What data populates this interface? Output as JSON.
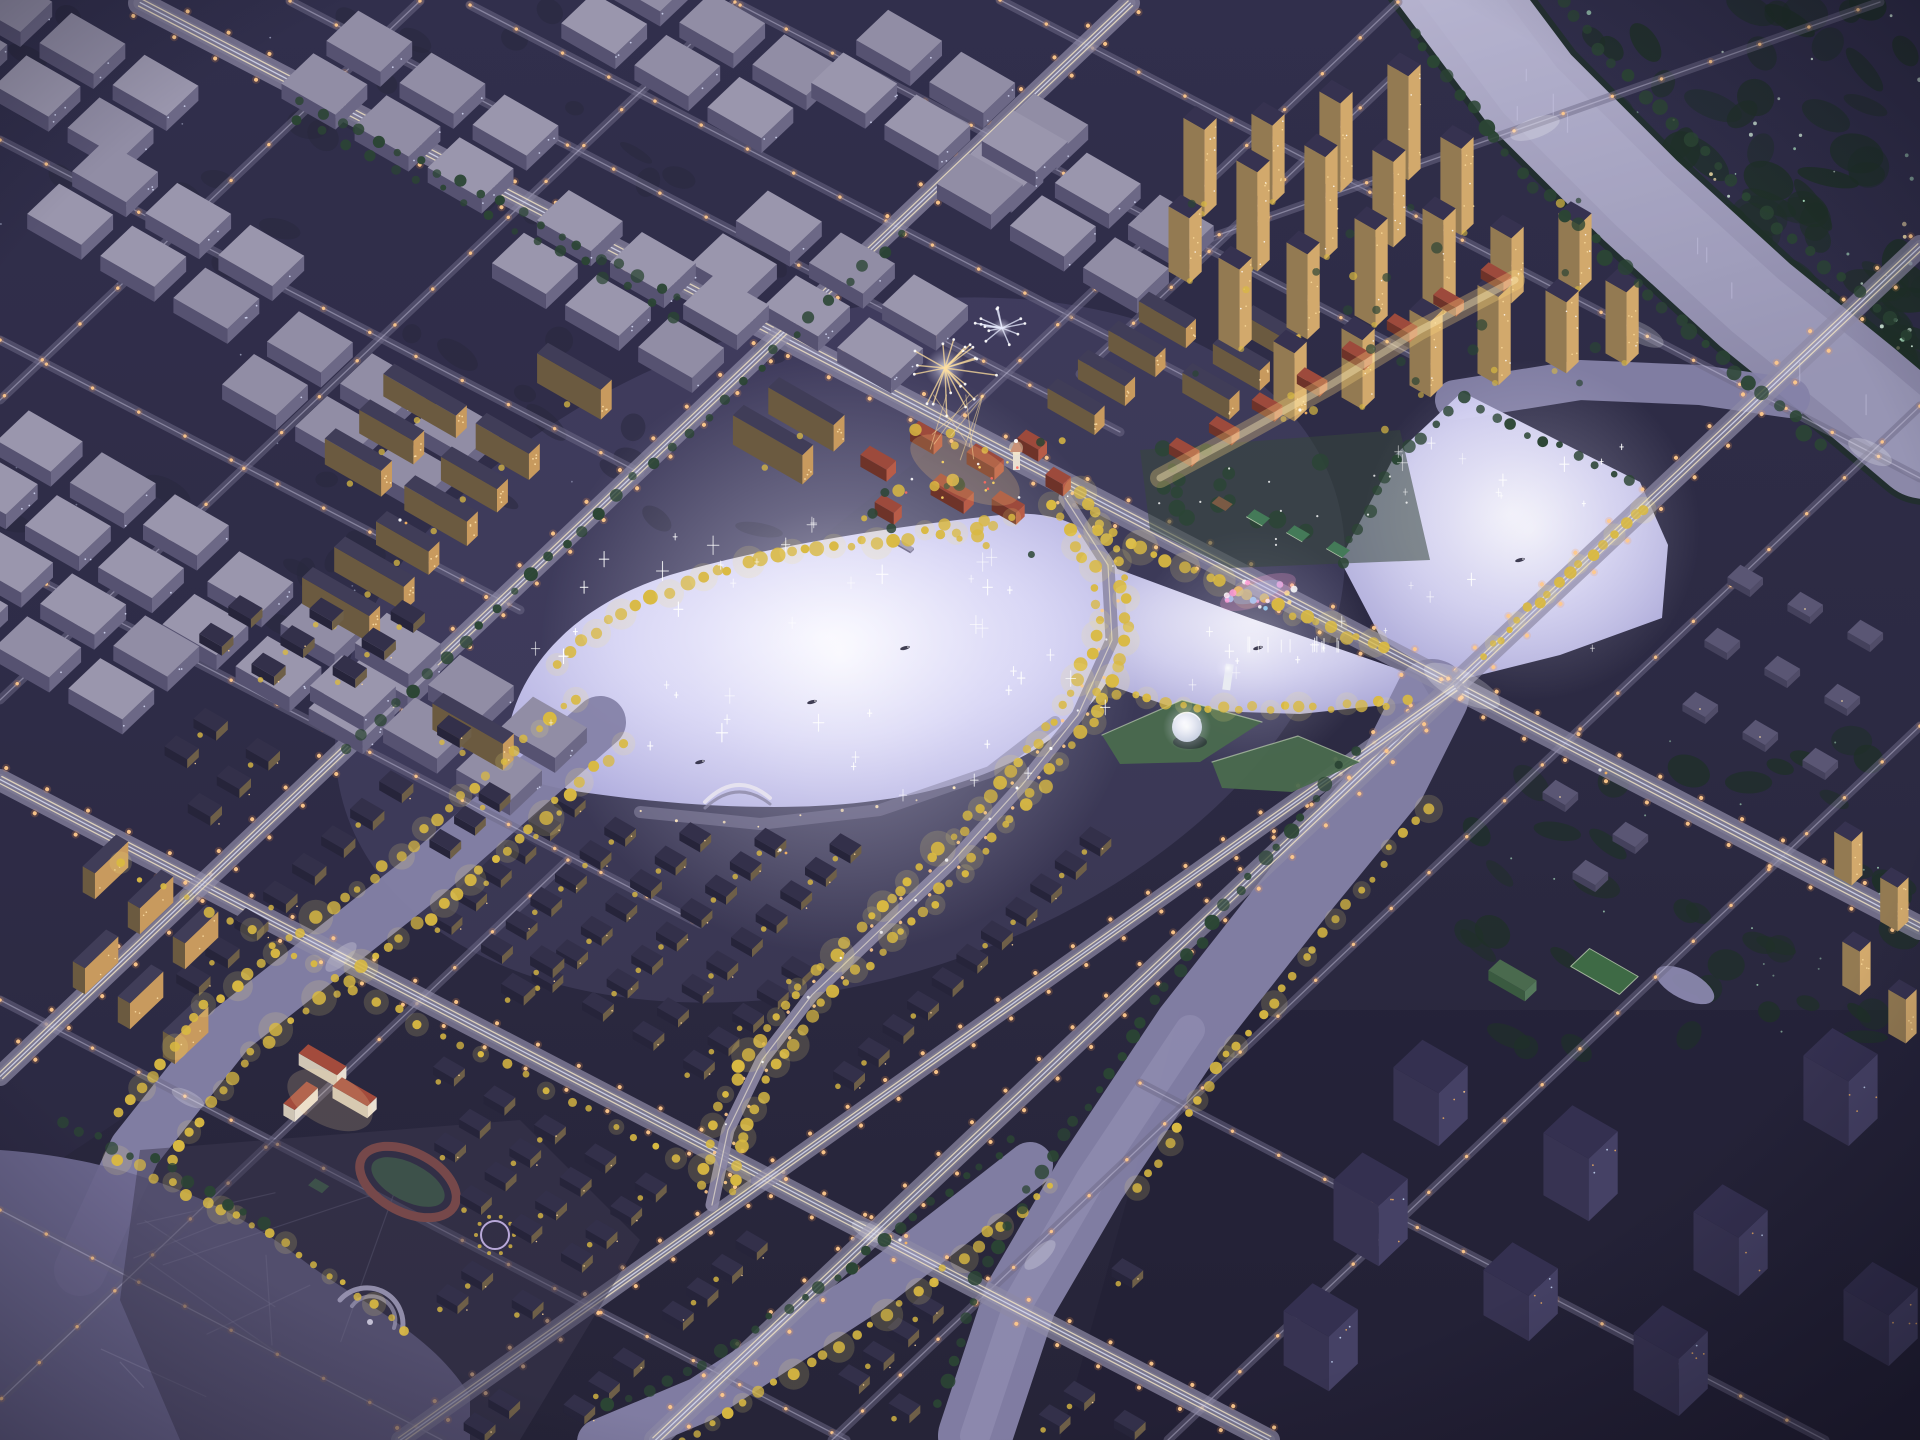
{
  "scene": {
    "description": "Oblique aerial night rendering of a riverside residential masterplan with illuminated central lake",
    "time_of_day": "night",
    "features": [
      {
        "name": "warehouse-district",
        "label": "industrial warehouse blocks, northwest"
      },
      {
        "name": "highrise-district",
        "label": "high-rise residential towers, northeast"
      },
      {
        "name": "midrise-district",
        "label": "mid-rise apartment slabs around lake"
      },
      {
        "name": "villa-district",
        "label": "townhouse rows, south"
      },
      {
        "name": "central-lake",
        "label": "illuminated central lake"
      },
      {
        "name": "river",
        "label": "curving river, northeast"
      },
      {
        "name": "canal-network",
        "label": "tree-lined canals"
      },
      {
        "name": "town-center",
        "label": "red-roof european town center with clock tower"
      },
      {
        "name": "cultural-center",
        "label": "green-roof cultural center with glowing bowl dome"
      },
      {
        "name": "commercial-street",
        "label": "red-roof lit commercial street"
      },
      {
        "name": "school-campus",
        "label": "school with running track"
      },
      {
        "name": "firework",
        "label": "gold firework burst"
      },
      {
        "name": "fountain",
        "label": "colorful lake fountain"
      },
      {
        "name": "marina-pier",
        "label": "circular pier on pond"
      }
    ]
  },
  "palette": {
    "sky": "#2c2a43",
    "skyDeep": "#232135",
    "tintNW": "#353152",
    "tintSE": "#1f1d31",
    "forest": "#1f3028",
    "forestHi": "#2d4a37",
    "forestLight": "#aee4c2",
    "road": "#6f6b88",
    "roadGlow": "#d9d5ee",
    "avenue": "#8e8aa6",
    "lane": "#f4e6c6",
    "laneCool": "#dfe3f6",
    "light": "#ffc98c",
    "lightHalo": "#ff9d4d",
    "river": "#9895b5",
    "riverHi": "#b6b3cf",
    "canal": "#8582a8",
    "lakeCore": "#f3f2fe",
    "lakeMid": "#cbc9f0",
    "lakeEdge": "#9e9bd2",
    "sparkle": "#ffffff",
    "treeYellow": "#d9b942",
    "treeYellowHi": "#f6e47c",
    "treeGreen": "#2b4534",
    "roofWare": "#918da5",
    "wareL": "#565271",
    "wareR": "#6c6886",
    "speck": "#dfe4ff",
    "facadeWarm": "#c89a5e",
    "facadeShade": "#6b5a40",
    "window": "#ffe2a8",
    "roofDark": "#403d58",
    "towerL": "#937a52",
    "towerR": "#d2a96c",
    "towerRoof": "#363250",
    "darkL": "#373352",
    "darkR": "#454165",
    "darkRoof": "#343050",
    "windowCool": "#cfe2ff",
    "villaRoof": "#33304a",
    "villaL": "#26243a",
    "villaR": "#6e5f48",
    "villaWin": "#ffd79b",
    "roofRed": "#9d4a3c",
    "roofRedL": "#6e3329",
    "roofRedHi": "#b85c48",
    "field": "#3e6a45",
    "track": "#b05844",
    "court": "#447a58",
    "courtBrown": "#7a5a44",
    "dome": "#eef2f8",
    "greenRoof": "#4a6a4e",
    "plaza": "#8d89a6",
    "fountainPink": "#ff9ed8",
    "fountainCyan": "#9ed8ff",
    "gold": "#ffdf9e",
    "white": "#ffffff",
    "schoolWall": "#e9e0d2",
    "schoolWallL": "#cfc5b5",
    "schoolRoof": "#a34b3c",
    "pond": "#6b678e",
    "dimL": "#44415c",
    "dimR": "#504c68",
    "dimRoof": "#5a5674"
  }
}
